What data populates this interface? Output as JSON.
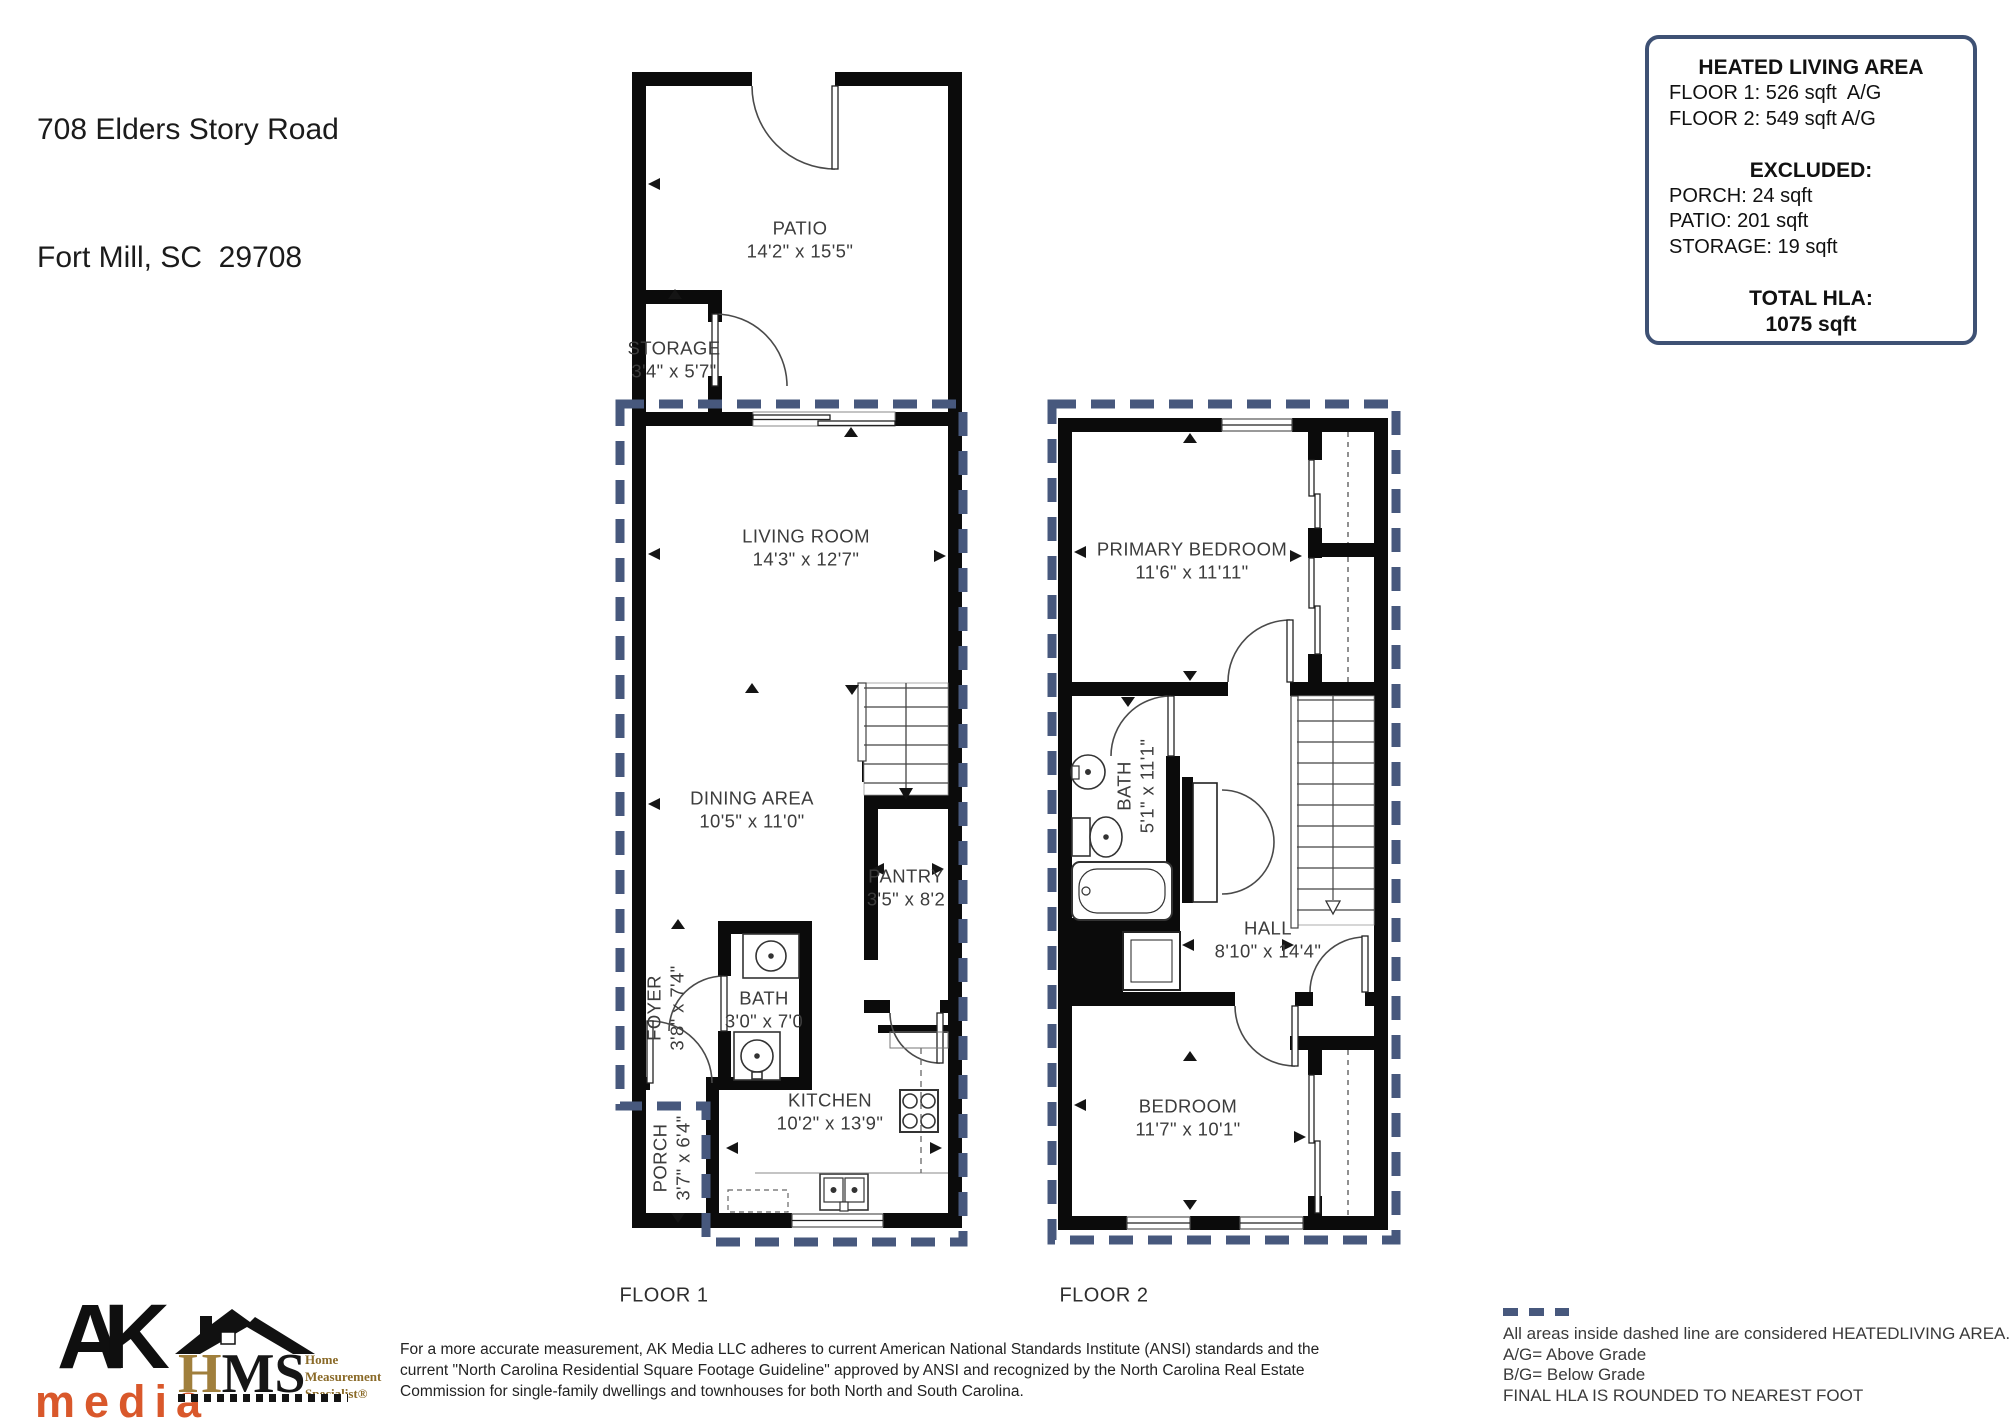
{
  "address": {
    "line1": "708 Elders Story Road",
    "line2": "Fort Mill, SC  29708"
  },
  "hla_box": {
    "title": "HEATED LIVING AREA",
    "floor1_line": "FLOOR 1: 526 sqft  A/G",
    "floor2_line": "FLOOR 2: 549 sqft A/G",
    "excluded_title": "EXCLUDED:",
    "excluded": [
      "PORCH: 24 sqft",
      "PATIO: 201 sqft",
      "STORAGE: 19 sqft"
    ],
    "total_title": "TOTAL HLA:",
    "total_value": "1075 sqft"
  },
  "floor1": {
    "caption": "FLOOR 1",
    "patio": {
      "name": "PATIO",
      "dims": "14'2\" x 15'5\""
    },
    "storage": {
      "name": "STORAGE",
      "dims": "3'4\" x 5'7\""
    },
    "living_room": {
      "name": "LIVING ROOM",
      "dims": "14'3\" x 12'7\""
    },
    "dining_area": {
      "name": "DINING AREA",
      "dims": "10'5\" x 11'0\""
    },
    "pantry": {
      "name": "PANTRY",
      "dims": "3'5\" x 8'2"
    },
    "foyer": {
      "name": "FOYER",
      "dims": "3'8\" x 7'4\""
    },
    "bath": {
      "name": "BATH",
      "dims": "3'0\" x 7'0"
    },
    "kitchen": {
      "name": "KITCHEN",
      "dims": "10'2\" x 13'9\""
    },
    "porch": {
      "name": "PORCH",
      "dims": "3'7\" x 6'4\""
    }
  },
  "floor2": {
    "caption": "FLOOR 2",
    "primary_bedroom": {
      "name": "PRIMARY BEDROOM",
      "dims": "11'6\" x 11'11\""
    },
    "bath": {
      "name": "BATH",
      "dims": "5'1\" x 11'1\""
    },
    "hall": {
      "name": "HALL",
      "dims": "8'10\" x 14'4\""
    },
    "bedroom": {
      "name": "BEDROOM",
      "dims": "11'7\" x 10'1\""
    }
  },
  "logos": {
    "ak_top": "AK",
    "ak_bottom": "media",
    "hms_h": "H",
    "hms_ms": "MS",
    "hms_tagline1": "Home",
    "hms_tagline2": "Measurement",
    "hms_tagline3": "Specialist®"
  },
  "disclaimer": "For a more accurate measurement, AK Media LLC adheres to current American National Standards Institute (ANSI) standards and the current \"North Carolina Residential Square Footage Guideline\" approved by ANSI and recognized by the North Carolina Real Estate Commission for single-family dwellings and townhouses for both North and South Carolina.",
  "legend": {
    "line1": "All areas inside dashed line are considered HEATEDLIVING AREA.",
    "ag": "A/G= Above Grade",
    "bg": "B/G= Below Grade",
    "final": "FINAL HLA IS ROUNDED TO NEAREST FOOT"
  },
  "colors": {
    "wall": "#0b0b0b",
    "hla_dashed_boundary": "#47587d",
    "box_border": "#3e5174",
    "ak_orange": "#d9582b",
    "hms_gold": "#a07f3c"
  }
}
